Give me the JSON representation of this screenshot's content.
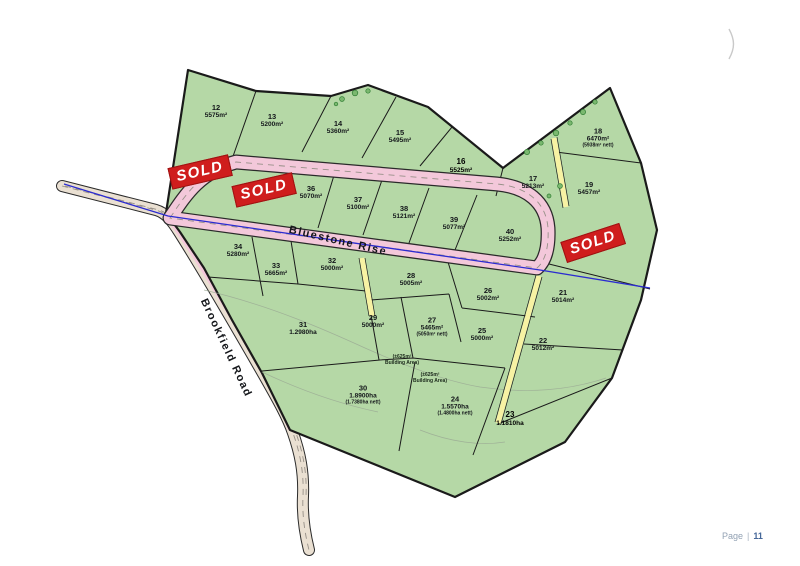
{
  "page": {
    "footer_prefix": "Page",
    "footer_separator": "|",
    "footer_number": "11"
  },
  "map": {
    "roads": [
      {
        "name": "Bluestone Rise",
        "x": 338,
        "y": 241,
        "rotation": 13
      },
      {
        "name": "Brookfield Road",
        "x": 226,
        "y": 348,
        "rotation": 65
      }
    ],
    "sold_stamps": [
      {
        "label": "SOLD",
        "x": 200,
        "y": 172,
        "rotation": -13
      },
      {
        "label": "SOLD",
        "x": 264,
        "y": 190,
        "rotation": -13
      },
      {
        "label": "SOLD",
        "x": 593,
        "y": 243,
        "rotation": -18
      }
    ],
    "lots": [
      {
        "num": "12",
        "area": "5575m²",
        "x": 216,
        "y": 112
      },
      {
        "num": "13",
        "area": "5200m²",
        "x": 272,
        "y": 121
      },
      {
        "num": "14",
        "area": "5360m²",
        "x": 338,
        "y": 128
      },
      {
        "num": "15",
        "area": "5495m²",
        "x": 400,
        "y": 137
      },
      {
        "num": "16",
        "area": "5525m²",
        "x": 461,
        "y": 166,
        "strong": true
      },
      {
        "num": "17",
        "area": "5213m²",
        "x": 533,
        "y": 183
      },
      {
        "num": "18",
        "area": "6470m²",
        "nett": "(5938m² nett)",
        "x": 598,
        "y": 138
      },
      {
        "num": "19",
        "area": "5457m²",
        "x": 589,
        "y": 189
      },
      {
        "num": "36",
        "area": "5070m²",
        "x": 311,
        "y": 193
      },
      {
        "num": "37",
        "area": "5100m²",
        "x": 358,
        "y": 204
      },
      {
        "num": "38",
        "area": "5121m²",
        "x": 404,
        "y": 213
      },
      {
        "num": "39",
        "area": "5077m²",
        "x": 454,
        "y": 224
      },
      {
        "num": "40",
        "area": "5252m²",
        "x": 510,
        "y": 236
      },
      {
        "num": "34",
        "area": "5280m²",
        "x": 238,
        "y": 251
      },
      {
        "num": "33",
        "area": "5665m²",
        "x": 276,
        "y": 270
      },
      {
        "num": "32",
        "area": "5000m²",
        "x": 332,
        "y": 265
      },
      {
        "num": "28",
        "area": "5005m²",
        "x": 411,
        "y": 280
      },
      {
        "num": "26",
        "area": "5002m²",
        "x": 488,
        "y": 295
      },
      {
        "num": "21",
        "area": "5014m²",
        "x": 563,
        "y": 297
      },
      {
        "num": "29",
        "area": "5000m²",
        "x": 373,
        "y": 322
      },
      {
        "num": "27",
        "area": "5465m²",
        "nett": "(5050m² nett)",
        "x": 432,
        "y": 327
      },
      {
        "num": "25",
        "area": "5000m²",
        "x": 482,
        "y": 335
      },
      {
        "num": "22",
        "area": "5012m²",
        "x": 543,
        "y": 345
      },
      {
        "num": "31",
        "area": "1.2980ha",
        "x": 303,
        "y": 329
      },
      {
        "num": "30",
        "area": "1.8900ha",
        "nett": "(1.7380ha nett)",
        "x": 363,
        "y": 395
      },
      {
        "num": "24",
        "area": "1.5570ha",
        "nett": "(1.4800ha nett)",
        "x": 455,
        "y": 406
      },
      {
        "num": "23",
        "area": "1.1810ha",
        "x": 510,
        "y": 419,
        "strong": true
      }
    ],
    "annotations": [
      {
        "text": "(±625m² Building Area)",
        "x": 402,
        "y": 360
      },
      {
        "text": "(±625m² Building Area)",
        "x": 430,
        "y": 378
      }
    ],
    "colors": {
      "lot_fill": "#b5d8a6",
      "road_pink": "#f3c8da",
      "road_beige": "#eae0d2",
      "strip_yellow": "#f7f2a3",
      "water_line": "#2b2bd0",
      "sold_red": "#cf1d1d",
      "boundary": "#1a1a1a"
    }
  }
}
